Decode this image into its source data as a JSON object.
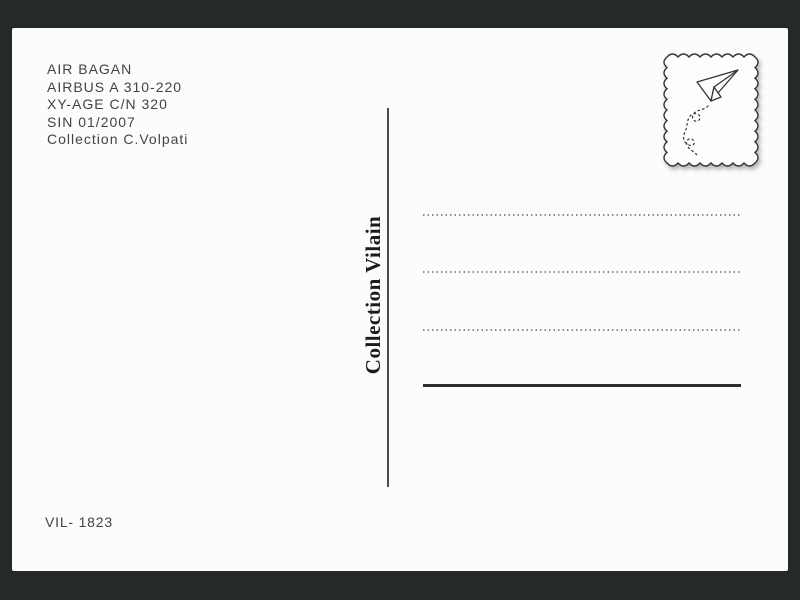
{
  "postcard": {
    "info_lines": [
      "AIR BAGAN",
      "AIRBUS A 310-220",
      "XY-AGE C/N 320",
      "SIN 01/2007",
      "Collection C.Volpati"
    ],
    "collection_label": "Collection Vilain",
    "catalog_number": "VIL- 1823",
    "stamp": {
      "icon": "paper-airplane-icon",
      "style": "scalloped-stamp-frame"
    },
    "address_area": {
      "dotted_lines": 3,
      "signature_line": 1
    },
    "colors": {
      "frame_background": "#252a26",
      "card_background": "#fdfbfc",
      "ink_text": "#454340",
      "divider": "#4a4a4a",
      "dotted_line": "#8f8c8d",
      "signature_line": "#2f2d2e",
      "stamp_stroke": "#333333"
    }
  }
}
